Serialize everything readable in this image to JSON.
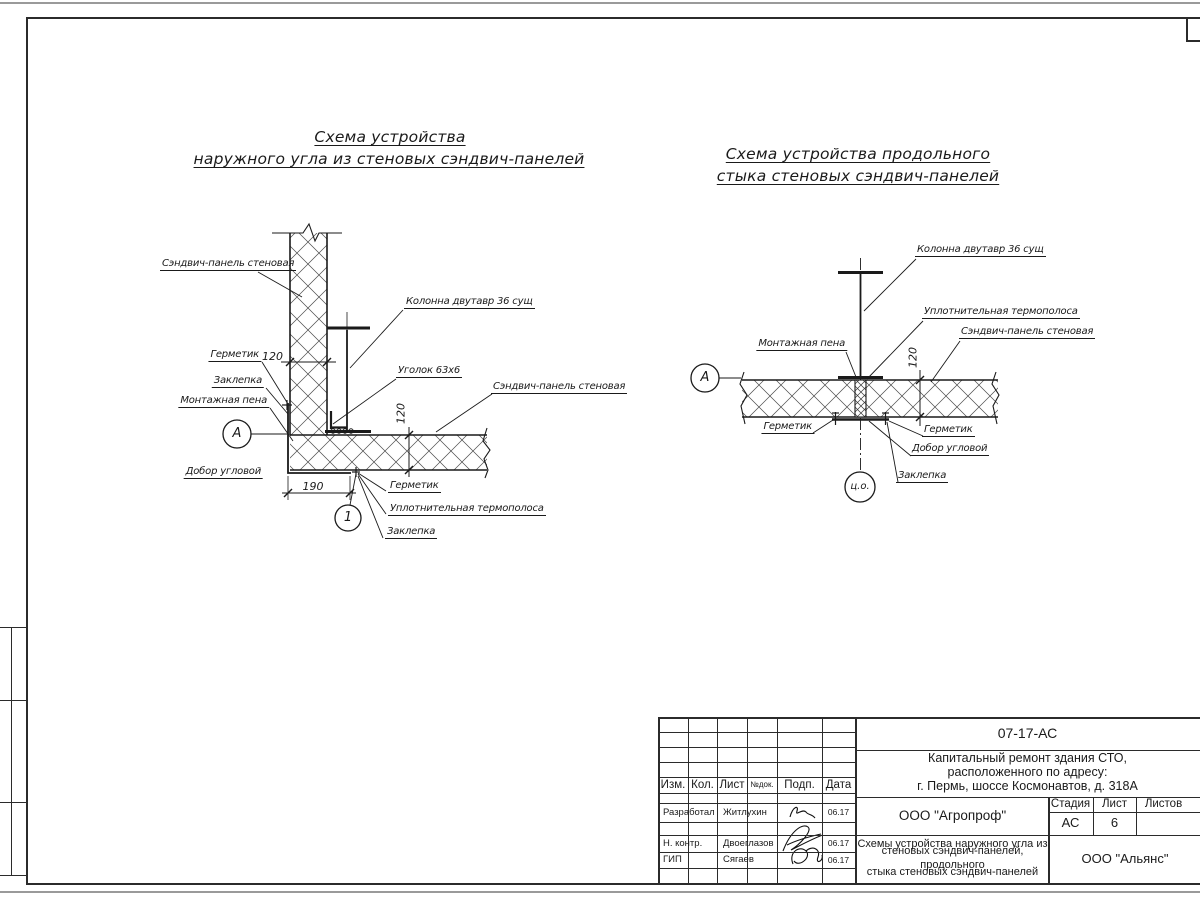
{
  "sheet": {
    "stamp": {
      "doc_number": "07-17-АС",
      "project_lines": [
        "Капитальный ремонт здания СТО,",
        "расположенного по адресу:",
        "г. Пермь, шоссе Космонавтов, д. 318А"
      ],
      "drawing_title_lines": [
        "Схемы устройства наружного угла из",
        "стеновых сэндвич-панелей, продольного",
        "стыка стеновых сэндвич-панелей"
      ],
      "designer_org": "ООО \"Агропроф\"",
      "client_org": "ООО \"Альянс\"",
      "stage_label": "Стадия",
      "sheet_label": "Лист",
      "sheets_label": "Листов",
      "stage_value": "АС",
      "sheet_value": "6",
      "col_izm": "Изм.",
      "col_kol": "Кол.",
      "col_list": "Лист",
      "col_doc": "№док.",
      "col_podp": "Подп.",
      "col_data": "Дата",
      "rows": [
        {
          "role": "Разработал",
          "name": "Житлухин",
          "date": "06.17"
        },
        {
          "role": "Н. контр.",
          "name": "Двоеглазов",
          "date": "06.17"
        },
        {
          "role": "ГИП",
          "name": "Сягаев",
          "date": "06.17"
        }
      ]
    }
  },
  "diagram_left": {
    "title1": "Схема устройства",
    "title2": "наружного угла из стеновых сэндвич-панелей",
    "labels": {
      "panel_top": "Сэндвич-панель стеновая",
      "column": "Колонна двутавр 36 сущ",
      "angle": "Уголок 63х6",
      "sealant_top": "Герметик",
      "rivet_top": "Заклепка",
      "foam": "Монтажная пена",
      "corner_trim": "Добор угловой",
      "panel_right": "Сэндвич-панель стеновая",
      "sealant_bottom": "Герметик",
      "thermal_strip": "Уплотнительная термополоса",
      "rivet_bottom": "Заклепка"
    },
    "dims": {
      "panel_width": "120",
      "panel_thickness": "120",
      "base": "190"
    },
    "marks": {
      "node": "А",
      "detail": "1"
    }
  },
  "diagram_right": {
    "title1": "Схема устройства продольного",
    "title2": "стыка стеновых сэндвич-панелей",
    "labels": {
      "column": "Колонна двутавр 36 сущ",
      "thermal_strip": "Уплотнительная термополоса",
      "panel": "Сэндвич-панель стеновая",
      "foam": "Монтажная пена",
      "sealant_left": "Герметик",
      "sealant_right": "Герметик",
      "corner_trim": "Добор угловой",
      "rivet": "Заклепка"
    },
    "dims": {
      "panel_thickness": "120"
    },
    "marks": {
      "node": "А",
      "axis": "ц.о."
    }
  }
}
